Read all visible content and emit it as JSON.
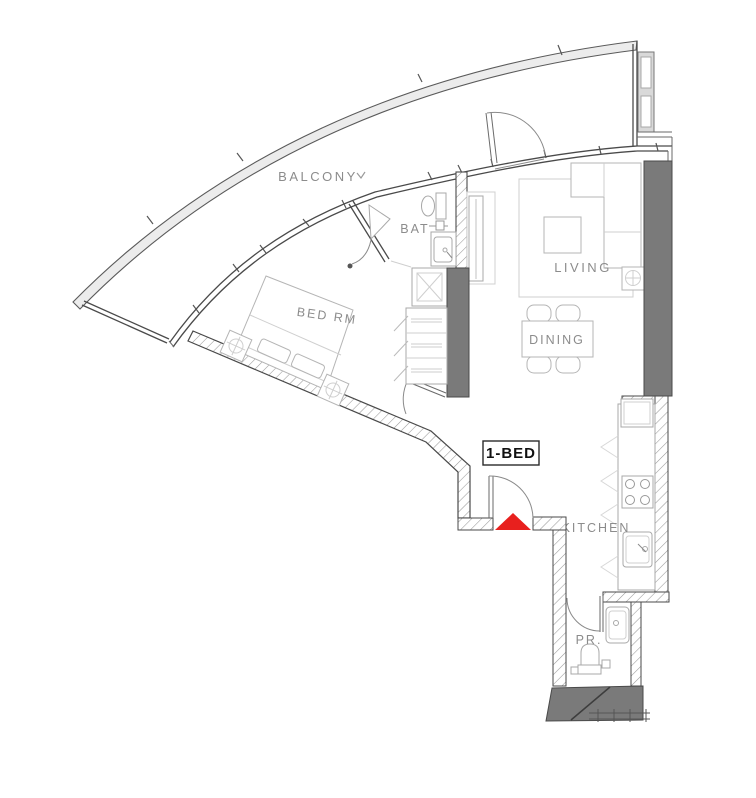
{
  "plan_title": "1-bedroom apartment floor plan",
  "unit": {
    "label": "1-BED"
  },
  "rooms": {
    "balcony": {
      "label": "BALCONY"
    },
    "bedroom": {
      "label": "BED RM"
    },
    "bathroom": {
      "label": "BAT"
    },
    "living": {
      "label": "LIVING"
    },
    "dining": {
      "label": "DINING"
    },
    "kitchen": {
      "label": "KITCHEN"
    },
    "powder_room": {
      "label": "PR."
    }
  },
  "colors": {
    "entrance_red": "#e8201e",
    "wall_fill": "#7a7a7a",
    "pier_fill": "#d9d9d9",
    "label_gray": "#8c8c8c",
    "unit_text": "#111111"
  }
}
